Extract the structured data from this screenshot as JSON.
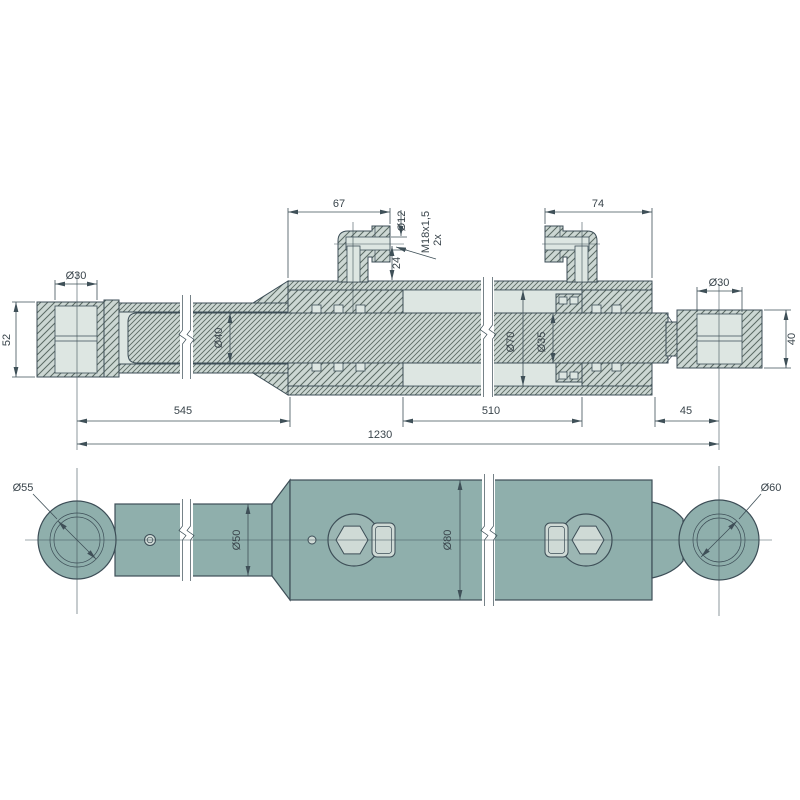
{
  "drawing": {
    "section": {
      "len_67": "67",
      "dia_12": "Ø12",
      "thread_m18": "M18x1,5",
      "thread_qty": "2x",
      "len_24": "24",
      "len_74": "74",
      "dia_30_left": "Ø30",
      "height_52": "52",
      "dia_40": "Ø40",
      "dia_70": "Ø70",
      "dia_35": "Ø35",
      "dia_30_right": "Ø30",
      "height_40": "40",
      "len_545": "545",
      "len_510": "510",
      "len_45": "45",
      "len_1230": "1230"
    },
    "outline": {
      "dia_55": "Ø55",
      "dia_50": "Ø50",
      "dia_80": "Ø80",
      "dia_60": "Ø60"
    },
    "colors": {
      "part_fill": "#8fafac",
      "section_fill": "#ccd7d3",
      "outline": "#3d4e57",
      "dimension": "#3f5058",
      "background": "#ffffff"
    }
  }
}
